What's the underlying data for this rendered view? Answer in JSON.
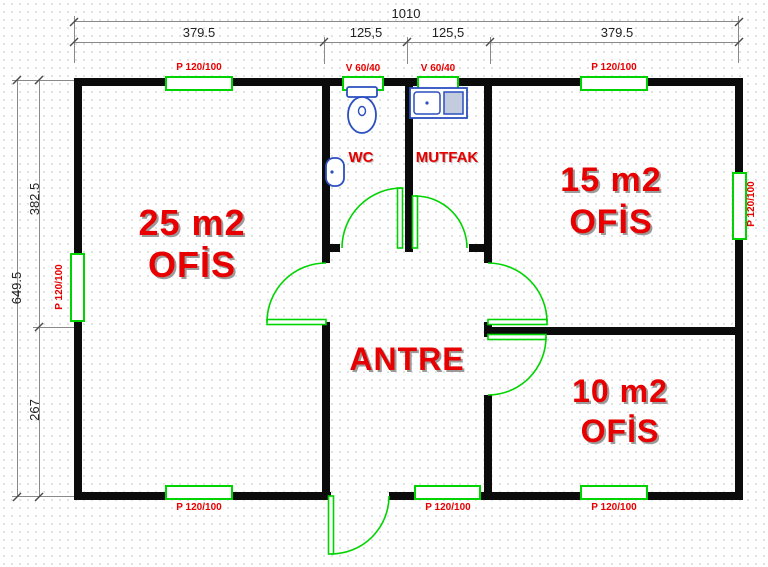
{
  "dimensions": {
    "total_width": "1010",
    "top_segments": [
      "379.5",
      "125,5",
      "125,5",
      "379.5"
    ],
    "total_height": "649.5",
    "left_segments": [
      "382.5",
      "267"
    ]
  },
  "rooms": {
    "office_25": {
      "area": "25 m2",
      "type": "OFİS"
    },
    "office_15": {
      "area": "15 m2",
      "type": "OFİS"
    },
    "office_10": {
      "area": "10 m2",
      "type": "OFİS"
    },
    "antre": {
      "label": "ANTRE"
    },
    "wc": {
      "label": "WC"
    },
    "mutfak": {
      "label": "MUTFAK"
    }
  },
  "windows": [
    {
      "position": "top-over-office-25",
      "label": "P 120/100"
    },
    {
      "position": "top-over-wc",
      "label": "V 60/40"
    },
    {
      "position": "top-over-mutfak",
      "label": "V 60/40"
    },
    {
      "position": "top-over-office-15",
      "label": "P 120/100"
    },
    {
      "position": "left-wall",
      "label": "P 120/100"
    },
    {
      "position": "right-wall",
      "label": "P 120/100"
    },
    {
      "position": "bottom-under-office-25",
      "label": "P 120/100"
    },
    {
      "position": "bottom-under-antre",
      "label": "P 120/100"
    },
    {
      "position": "bottom-under-office-10",
      "label": "P 120/100"
    }
  ],
  "colors": {
    "wall": "#0b0b0b",
    "joinery_green": "#00d400",
    "label_red": "#e80000",
    "fixture_blue": "#2b4fc0",
    "dimension_gray": "#8a8a8a"
  }
}
